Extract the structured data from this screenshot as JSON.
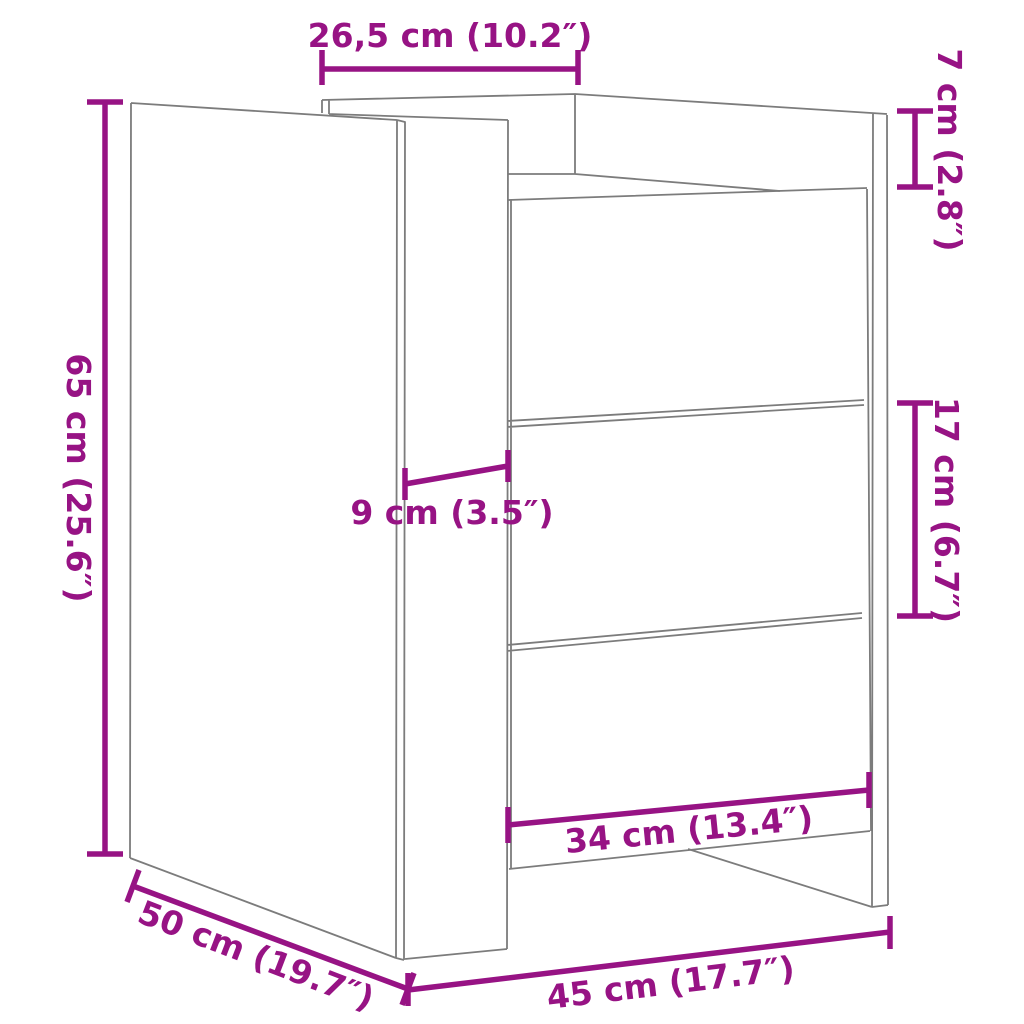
{
  "diagram": {
    "subject": "bedside cabinet with three drawers, perspective line drawing with dimension annotations",
    "background_color": "#ffffff",
    "line_color": "#7c7c7c",
    "dimension_color": "#971384",
    "dimensions": [
      {
        "name": "top-panel-depth",
        "label": "26,5 cm (10.2″)",
        "cm": "26,5",
        "inches": "10.2"
      },
      {
        "name": "top-rail-height",
        "label": "7 cm (2.8″)",
        "cm": "7",
        "inches": "2.8"
      },
      {
        "name": "overall-height",
        "label": "65 cm (25.6″)",
        "cm": "65",
        "inches": "25.6"
      },
      {
        "name": "side-panel-inset",
        "label": "9 cm (3.5″)",
        "cm": "9",
        "inches": "3.5"
      },
      {
        "name": "drawer-height",
        "label": "17 cm (6.7″)",
        "cm": "17",
        "inches": "6.7"
      },
      {
        "name": "drawer-width",
        "label": "34 cm (13.4″)",
        "cm": "34",
        "inches": "13.4"
      },
      {
        "name": "overall-depth",
        "label": "50 cm (19.7″)",
        "cm": "50",
        "inches": "19.7"
      },
      {
        "name": "overall-width",
        "label": "45 cm (17.7″)",
        "cm": "45",
        "inches": "17.7"
      }
    ]
  }
}
